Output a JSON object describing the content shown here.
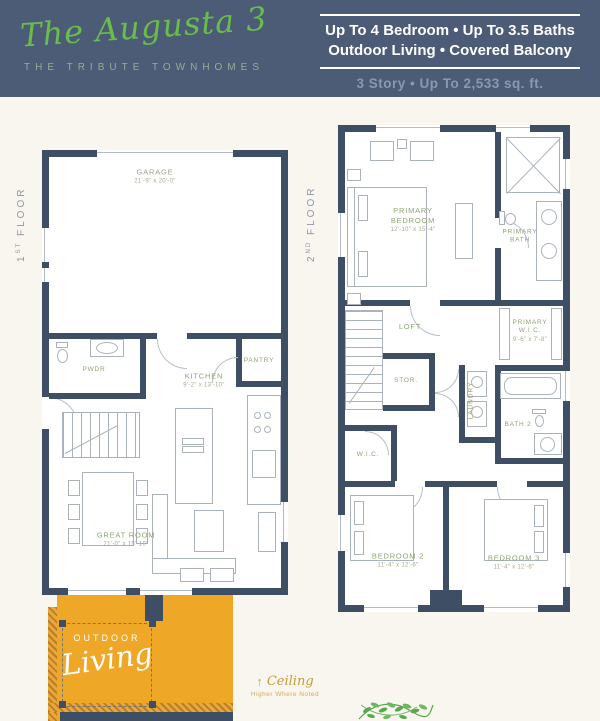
{
  "header": {
    "title": "The Augusta 3",
    "subtitle": "THE TRIBUTE TOWNHOMES",
    "spec_line1": "Up To 4 Bedroom • Up To 3.5 Baths",
    "spec_line2": "Outdoor Living • Covered Balcony",
    "spec_line3": "3 Story • Up To 2,533 sq. ft."
  },
  "floor1": {
    "label_num": "1",
    "label_sup": "ST",
    "label_word": " FLOOR",
    "garage": {
      "name": "GARAGE",
      "dims": "21'-9\" x 20'-0\""
    },
    "pwdr": {
      "name": "PWDR"
    },
    "kitchen": {
      "name": "KITCHEN",
      "dims": "9'-2\" x 13'-10\""
    },
    "pantry": {
      "name": "PANTRY"
    },
    "great_room": {
      "name": "GREAT ROOM",
      "dims": "21'-0\" x 15'-10\""
    },
    "outdoor": {
      "line1": "OUTDOOR",
      "line2": "Living"
    },
    "ceiling_note": {
      "arrow": "↑",
      "word": "Ceiling",
      "note": "Higher Where Noted"
    }
  },
  "floor2": {
    "label_num": "2",
    "label_sup": "ND",
    "label_word": " FLOOR",
    "primary_bedroom": {
      "name": "PRIMARY BEDROOM",
      "dims": "12'-10\" x 15'-4\""
    },
    "primary_bath": {
      "name": "PRIMARY BATH"
    },
    "loft": {
      "name": "LOFT"
    },
    "stor": {
      "name": "STOR."
    },
    "primary_wic": {
      "name": "PRIMARY W.I.C.",
      "dims": "9'-6\" x 7'-8\""
    },
    "laundry": {
      "name": "LAUNDRY"
    },
    "bath2": {
      "name": "BATH 2"
    },
    "wic": {
      "name": "W.I.C."
    },
    "bedroom2": {
      "name": "BEDROOM 2",
      "dims": "11'-4\" x 12'-6\""
    },
    "bedroom3": {
      "name": "BEDROOM 3",
      "dims": "11'-4\" x 12'-6\""
    }
  },
  "colors": {
    "header_bg": "#4c5b76",
    "brand_green": "#69bd4a",
    "wall_navy": "#3e4e65",
    "outdoor_orange": "#efa728",
    "label_green": "#8da572"
  }
}
